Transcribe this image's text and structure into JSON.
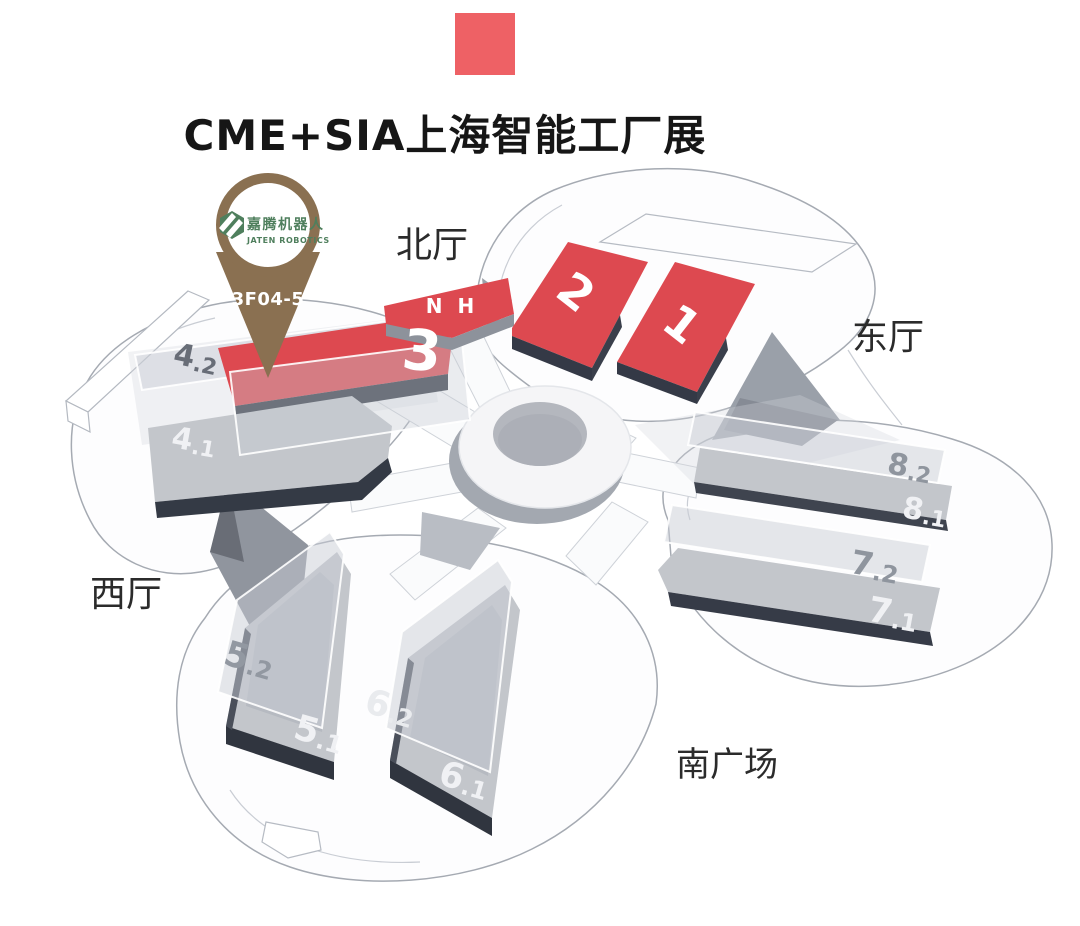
{
  "header": {
    "title": "CME+SIA上海智能工厂展"
  },
  "pin": {
    "booth": "3F04-5",
    "brand_cn": "嘉腾机器人",
    "brand_en": "JATEN ROBOTICS"
  },
  "direction_labels": {
    "north": "北厅",
    "east": "东厅",
    "west": "西厅",
    "south_plaza": "南广场"
  },
  "halls": {
    "hall_1": "1",
    "hall_2": "2",
    "hall_3": "3",
    "hall_nh": "N H",
    "hall_4_2": {
      "main": "4",
      "sub": ".2"
    },
    "hall_4_1": {
      "main": "4",
      "sub": ".1"
    },
    "hall_8_2": {
      "main": "8",
      "sub": ".2"
    },
    "hall_8_1": {
      "main": "8",
      "sub": ".1"
    },
    "hall_7_2": {
      "main": "7",
      "sub": ".2"
    },
    "hall_7_1": {
      "main": "7",
      "sub": ".1"
    },
    "hall_5_2": {
      "main": "5",
      "sub": ".2"
    },
    "hall_5_1": {
      "main": "5",
      "sub": ".1"
    },
    "hall_6_2": {
      "main": "6",
      "sub": ".2"
    },
    "hall_6_1": {
      "main": "6",
      "sub": ".1"
    }
  },
  "colors": {
    "accent_red": "#ee6165",
    "hall_red": "#dd4950",
    "hall_gray": "#c3c6cb",
    "pin_brown": "#8a7051",
    "logo_green": "#4f7f5d",
    "label_gray": "#8f959e",
    "label_white": "#f0f1f4"
  }
}
